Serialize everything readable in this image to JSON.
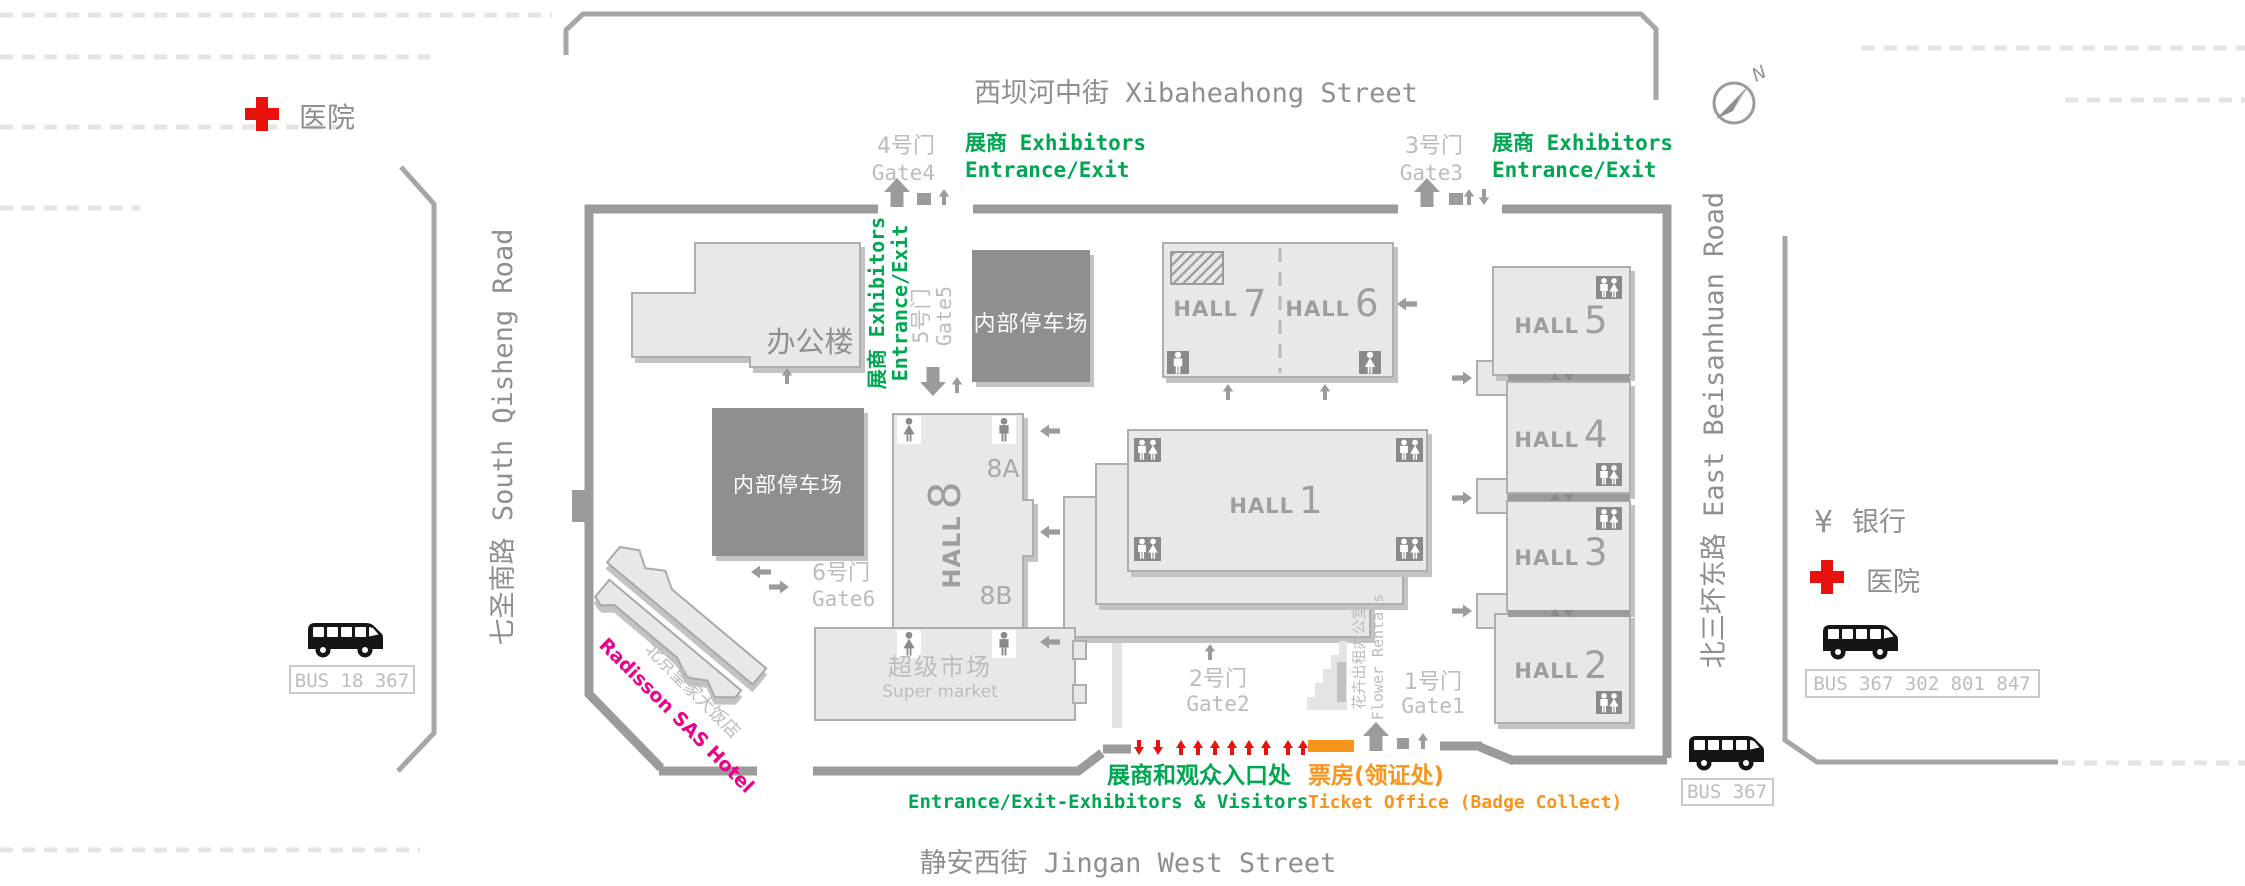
{
  "streets": {
    "north": "西坝河中街 Xibaheahong Street",
    "south": "静安西街 Jingan West Street",
    "west": "七圣南路 South Qisheng Road",
    "east": "北三坏东路 East Beisanhuan Road"
  },
  "compass": {
    "north_letter": "N"
  },
  "pois": {
    "hospital_west": "医院",
    "hospital_east": "医院",
    "bank_symbol": "¥",
    "bank": "银行",
    "office": "办公楼",
    "parking_north": "内部停车场",
    "parking_west": "内部停车场",
    "supermarket_cn": "超级市场",
    "supermarket_en": "Super market",
    "hotel_cn": "北京皇家大饭店",
    "hotel_en": "Radisson SAS Hotel",
    "flower_cn": "花卉出租办公室",
    "flower_en": "Flower Rentals"
  },
  "gates": {
    "g1": {
      "cn": "1号门",
      "en": "Gate1"
    },
    "g2": {
      "cn": "2号门",
      "en": "Gate2"
    },
    "g3": {
      "cn": "3号门",
      "en": "Gate3"
    },
    "g4": {
      "cn": "4号门",
      "en": "Gate4"
    },
    "g5": {
      "cn": "5号门",
      "en": "Gate5"
    },
    "g6": {
      "cn": "6号门",
      "en": "Gate6"
    }
  },
  "halls": {
    "h1": {
      "word": "HALL",
      "num": "1"
    },
    "h2": {
      "word": "HALL",
      "num": "2"
    },
    "h3": {
      "word": "HALL",
      "num": "3"
    },
    "h4": {
      "word": "HALL",
      "num": "4"
    },
    "h5": {
      "word": "HALL",
      "num": "5"
    },
    "h6": {
      "word": "HALL",
      "num": "6"
    },
    "h7": {
      "word": "HALL",
      "num": "7"
    },
    "h8": {
      "word": "HALL",
      "num": "8",
      "sub_a": "8A",
      "sub_b": "8B"
    }
  },
  "annotations": {
    "gate4_line1": "展商 Exhibitors",
    "gate4_line2": "Entrance/Exit",
    "gate3_line1": "展商 Exhibitors",
    "gate3_line2": "Entrance/Exit",
    "gate5_line1": "展商 Exhibitors",
    "gate5_line2": "Entrance/Exit",
    "entrance_cn": "展商和观众入口处",
    "entrance_en": "Entrance/Exit-Exhibitors & Visitors",
    "ticket_cn": "票房(领证处)",
    "ticket_en": "Ticket Office (Badge Collect)"
  },
  "bus_stops": {
    "west": "BUS 18 367",
    "east": "BUS 367 302 801 847",
    "south": "BUS 367"
  },
  "colors": {
    "green": "#00A651",
    "orange": "#F7941D",
    "red": "#E8120C",
    "pink": "#EC008C",
    "wall_gray": "#9B9B9B",
    "building_fill": "#E8E8E8",
    "dark_parking": "#8F8F8F",
    "label_gray": "#8F8F8F",
    "light_label": "#BCBCBC"
  }
}
